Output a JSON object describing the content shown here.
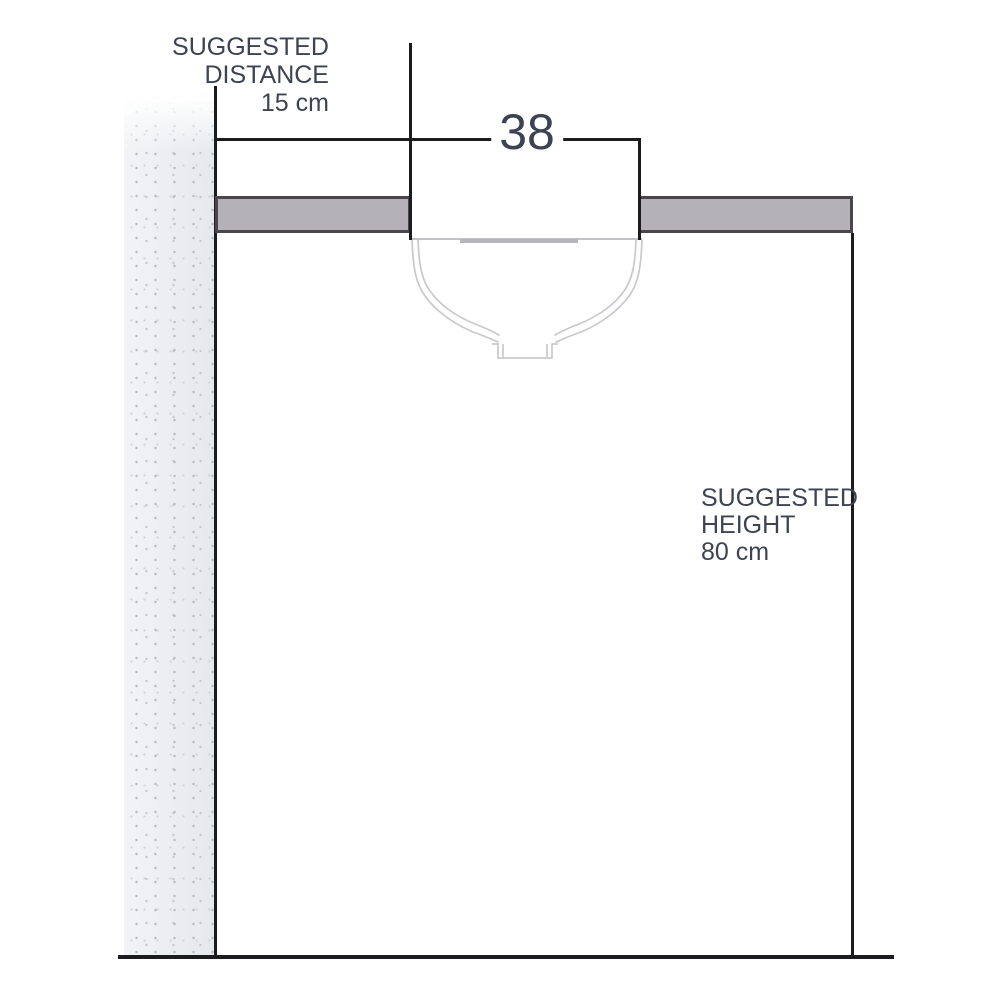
{
  "diagram": {
    "distance_label": {
      "line1": "SUGGESTED",
      "line2": "DISTANCE",
      "value": "15 cm"
    },
    "width_label": {
      "value": "38"
    },
    "height_label": {
      "line1": "SUGGESTED",
      "line2": "HEIGHT",
      "value": "80 cm"
    },
    "colors": {
      "background": "#ffffff",
      "line": "#1c1c20",
      "text": "#3d4353",
      "countertop_fill": "#b4b1b8",
      "countertop_border": "#4b464c",
      "wall_fill": "#e9ebee",
      "sink_outline": "#c9c9cd",
      "sink_rim": "#c2c2c6",
      "sink_shadow": "#b7b7bb"
    }
  }
}
